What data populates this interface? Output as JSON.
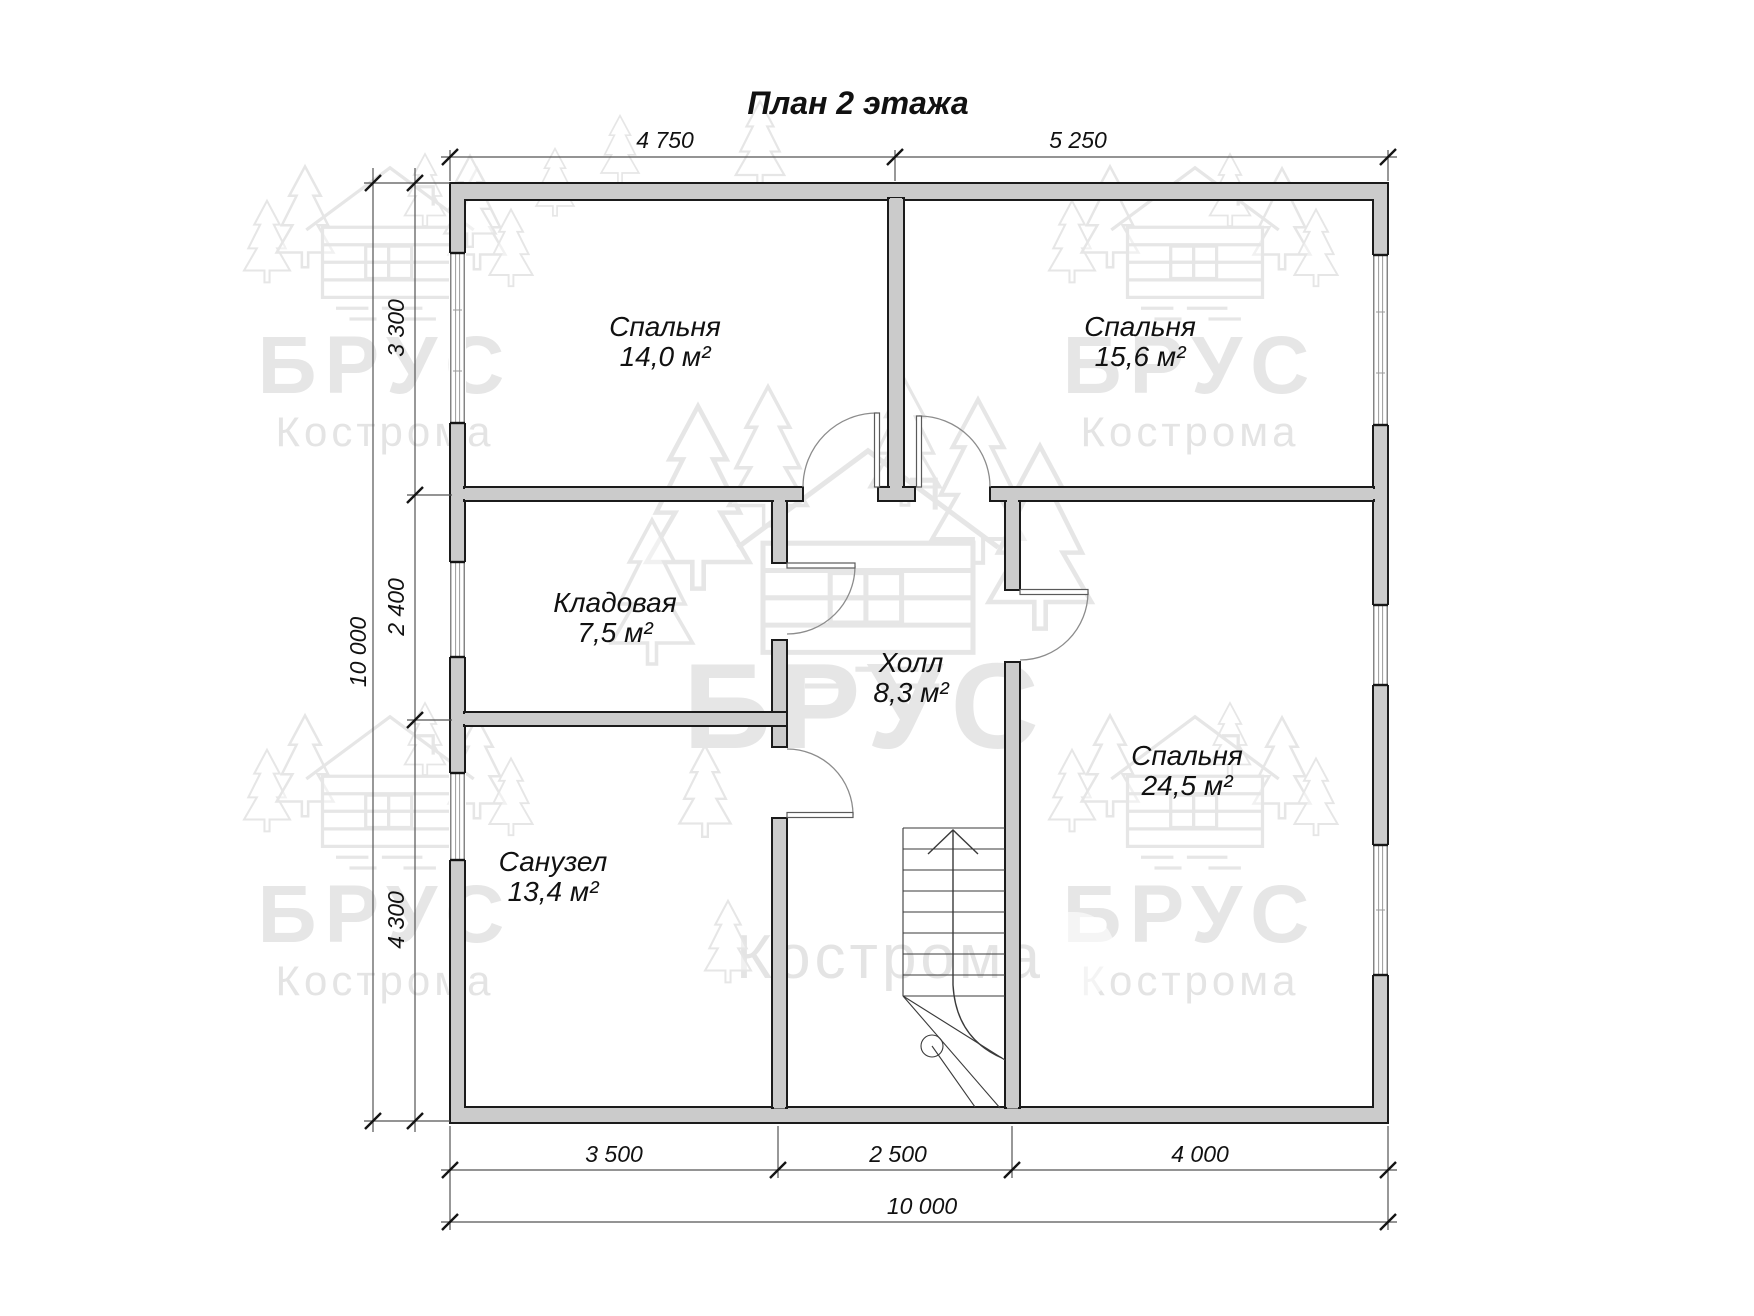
{
  "title": "План 2 этажа",
  "watermark": {
    "brand": "БРУС",
    "city": "Кострома"
  },
  "rooms": [
    {
      "id": "bedroom-1",
      "name": "Спальня",
      "area": "14,0 м²"
    },
    {
      "id": "bedroom-2",
      "name": "Спальня",
      "area": "15,6 м²"
    },
    {
      "id": "storage",
      "name": "Кладовая",
      "area": "7,5 м²"
    },
    {
      "id": "hall",
      "name": "Холл",
      "area": "8,3 м²"
    },
    {
      "id": "bedroom-3",
      "name": "Спальня",
      "area": "24,5 м²"
    },
    {
      "id": "bathroom",
      "name": "Санузел",
      "area": "13,4 м²"
    }
  ],
  "dimensions": {
    "top": [
      "4 750",
      "5 250"
    ],
    "left": [
      "3 300",
      "2 400",
      "4 300"
    ],
    "left_total": "10 000",
    "bottom": [
      "3 500",
      "2 500",
      "4 000"
    ],
    "bottom_total": "10 000"
  },
  "colors": {
    "wall_fill": "#cbcbcb",
    "outline": "#1b1b1b",
    "dimension": "#545454",
    "watermark": "#d2d2d2"
  }
}
